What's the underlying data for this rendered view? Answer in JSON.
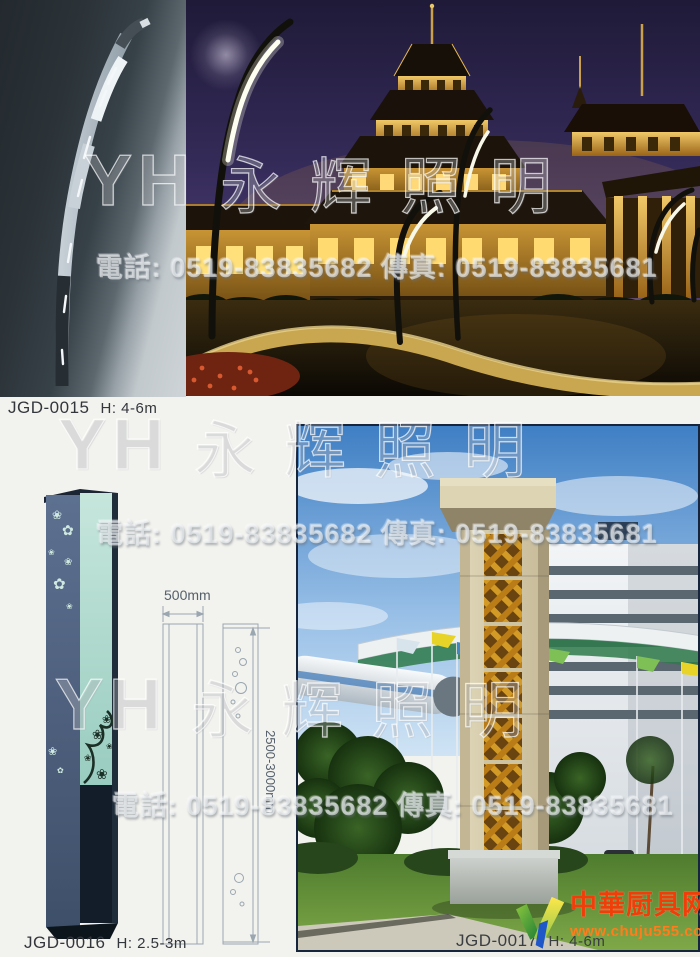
{
  "page": {
    "background": "#f2f2ee"
  },
  "watermark": {
    "monogram": "YH",
    "brand": "永辉照明",
    "contact": "電話: 0519-83835682 傳真: 0519-83835681"
  },
  "products": [
    {
      "code": "JGD-0015",
      "height": "H: 4-6m"
    },
    {
      "code": "JGD-0016",
      "height": "H: 2.5-3m"
    },
    {
      "code": "JGD-0017",
      "height": "H: 4-6m"
    }
  ],
  "drawing": {
    "width_label": "500mm",
    "height_label": "2500-3000mm"
  },
  "site_logo": {
    "name": "中華厨具网",
    "url": "www.chuju555.com",
    "name_color": "#f13d08",
    "url_color": "#ff7d1c"
  }
}
